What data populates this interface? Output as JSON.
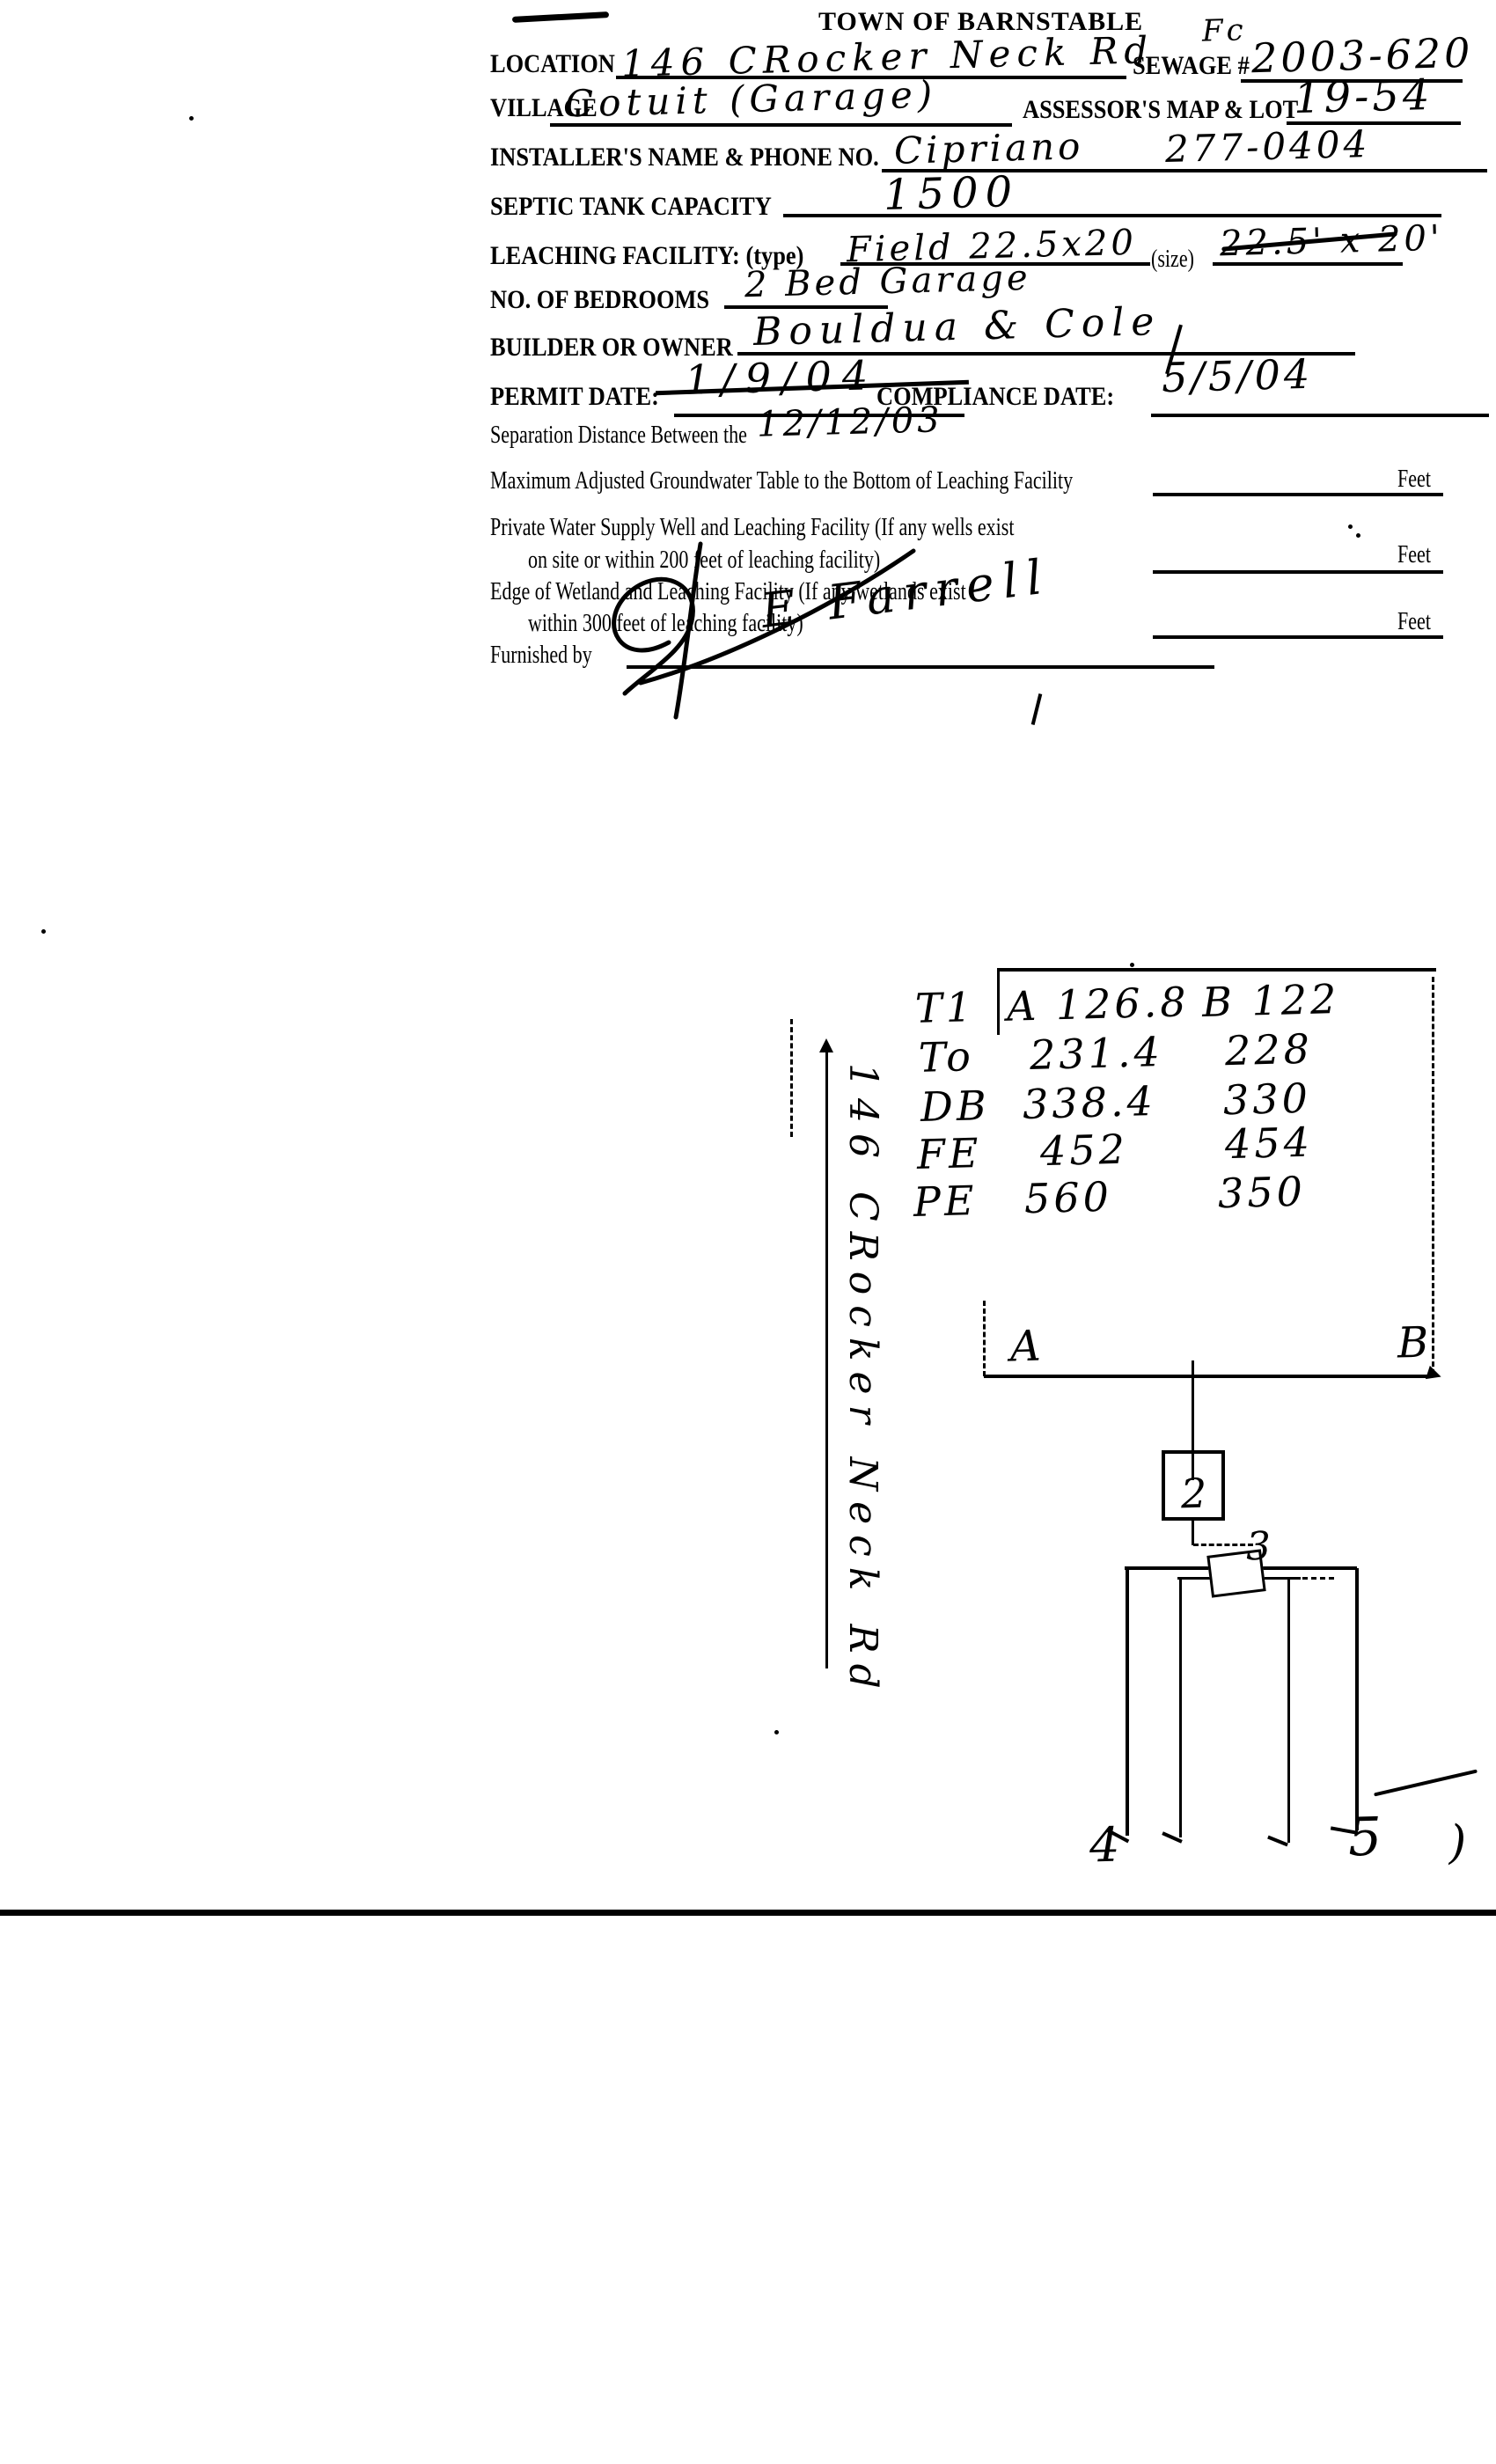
{
  "form": {
    "title": "TOWN OF BARNSTABLE",
    "corner_note": "Fc",
    "location": {
      "label": "LOCATION",
      "value": "146 CRocker Neck Rd"
    },
    "sewage": {
      "label": "SEWAGE #",
      "value": "2003-620"
    },
    "village": {
      "label": "VILLAGE",
      "value": "Cotuit (Garage)"
    },
    "map_lot": {
      "label": "ASSESSOR'S MAP & LOT",
      "value": "19-54"
    },
    "installer": {
      "label": "INSTALLER'S NAME & PHONE NO.",
      "name": "Cipriano",
      "phone": "277-0404"
    },
    "septic": {
      "label": "SEPTIC TANK CAPACITY",
      "value": "1500"
    },
    "leaching": {
      "label": "LEACHING FACILITY: (type)",
      "type_value": "Field 22.5x20",
      "size_label": "(size)",
      "size_value": "22.5' x 20'"
    },
    "bedrooms": {
      "label": "NO. OF BEDROOMS",
      "value": "2 Bed Garage"
    },
    "builder": {
      "label": "BUILDER OR OWNER",
      "value": "Bouldua & Cole"
    },
    "permit": {
      "label": "PERMIT DATE:",
      "value": "1/9/04",
      "revised": "12/12/03"
    },
    "compliance": {
      "label": "COMPLIANCE DATE:",
      "value": "5/5/04"
    },
    "separation_heading": "Separation Distance Between the",
    "groundwater_line": "Maximum Adjusted Groundwater Table to the Bottom of Leaching Facility",
    "well_line1": "Private Water Supply Well and Leaching Facility  (If any wells exist",
    "well_line2": "on site or within 200 feet of leaching facility)",
    "wetland_line1": "Edge of Wetland and Leaching Facility (If any wetlands exist",
    "wetland_line2": "within 300 feet of leaching facility)",
    "feet_label": "Feet",
    "furnished": {
      "label": "Furnished by",
      "signature": "E Farrell"
    }
  },
  "diagram": {
    "road_label": "146 CRocker Neck Rd",
    "corner_a": "A",
    "corner_b": "B",
    "tank_label": "2",
    "dbox_label": "3",
    "trench_left_label": "4",
    "trench_right_label": "5",
    "paren_mark": ")",
    "table": {
      "rows": [
        {
          "id": "T1",
          "a": "A 126.8",
          "b": "B 122"
        },
        {
          "id": "To",
          "a": "231.4",
          "b": "228"
        },
        {
          "id": "DB",
          "a": "338.4",
          "b": "330"
        },
        {
          "id": "FE",
          "a": "452",
          "b": "454"
        },
        {
          "id": "PE",
          "a": "560",
          "b": "350"
        }
      ]
    }
  },
  "colors": {
    "ink": "#000000",
    "paper": "#ffffff"
  }
}
